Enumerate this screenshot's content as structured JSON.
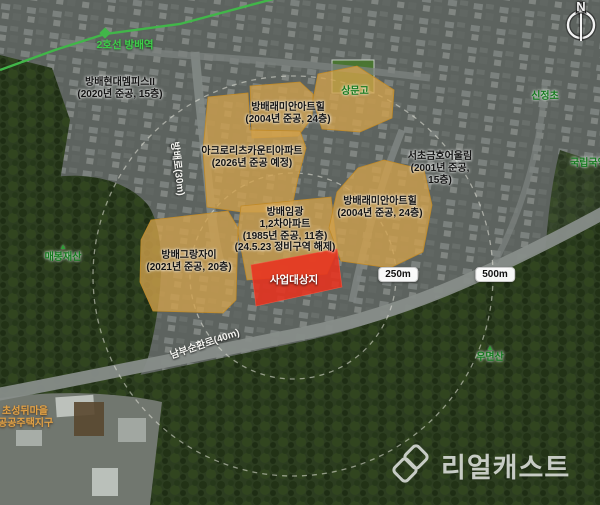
{
  "map": {
    "subway": {
      "station_label": "2호선 방배역",
      "line_color": "#41b649"
    },
    "complex_labels": {
      "hyundai": {
        "lines": [
          "방배현대멤피스II",
          "(2020년 준공, 15층)"
        ]
      },
      "raemian_top": {
        "lines": [
          "방배래미안아트힐",
          "(2004년 준공, 24층)"
        ]
      },
      "acro": {
        "lines": [
          "아크로리츠카운티아파트",
          "(2026년 준공 예정)"
        ]
      },
      "geumho": {
        "lines": [
          "서초금호어울림",
          "(2001년 준공,",
          "15층)"
        ]
      },
      "raemian_right": {
        "lines": [
          "방배래미안아트힐",
          "(2004년 준공, 24층)"
        ]
      },
      "imgwang": {
        "lines": [
          "방배임광",
          "1,2차아파트",
          "(1985년 준공, 11층)",
          "(24.5.23 정비구역 해제)"
        ]
      },
      "grangjai": {
        "lines": [
          "방배그랑자이",
          "(2021년 준공, 20층)"
        ]
      }
    },
    "site_label": "사업대상지",
    "places": {
      "sangmun": "상문고",
      "sinjeong": "신정초",
      "gugak": "국립국악원",
      "maebong": "매봉재산",
      "umyeon": "우면산",
      "seongdwi": {
        "lines": [
          "초성뒤마을",
          "공공주택지구"
        ]
      }
    },
    "roads": {
      "nambu": "남부순환로(40m)",
      "bangbae": "방배로(30m)"
    },
    "scale_rings": {
      "inner": "250m",
      "outer": "500m"
    },
    "compass": {
      "north": "N"
    },
    "colors": {
      "complex_fill": "#d2a24b",
      "site_fill": "#e8321f",
      "subway_green": "#41b649",
      "place_green": "#157a1f"
    },
    "watermark": {
      "brand": "리얼캐스트"
    }
  }
}
